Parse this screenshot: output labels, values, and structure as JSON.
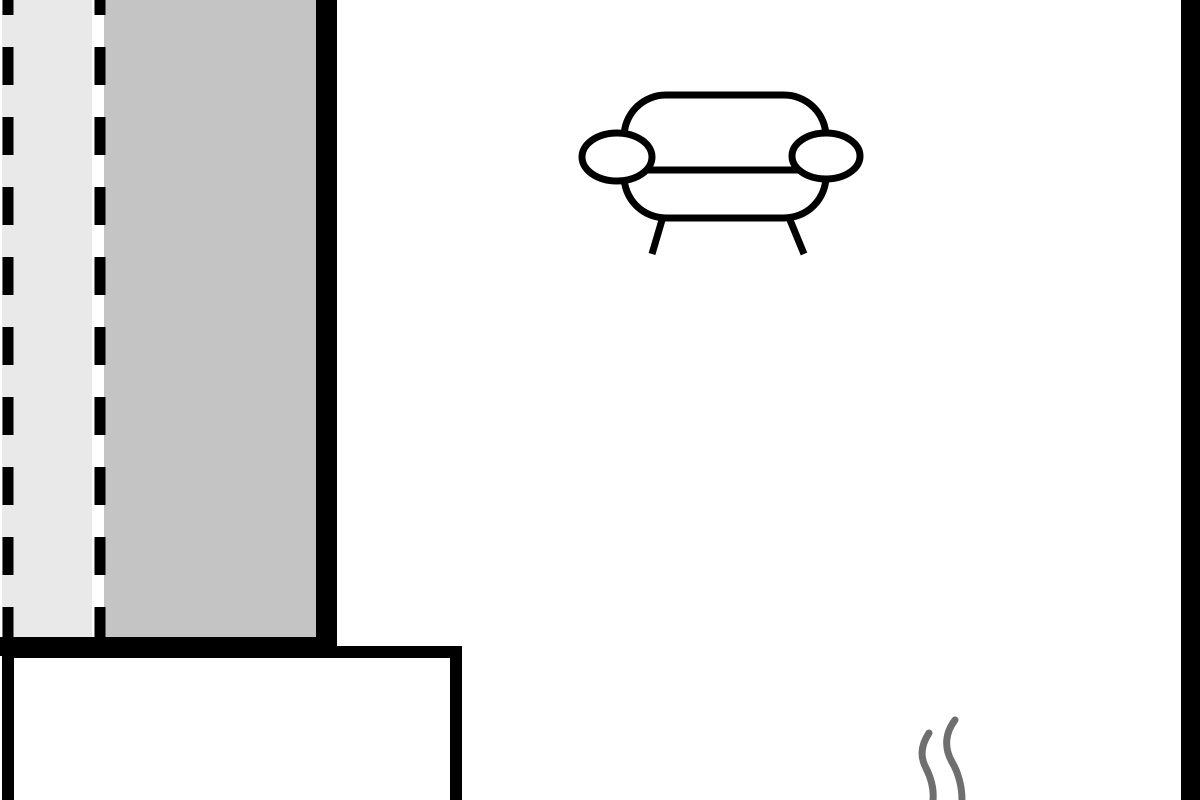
{
  "floorplan": {
    "description": "floor-plan fragment with shaded window zone, walls, sofa symbol and steam marks",
    "canvas": {
      "width": 1200,
      "height": 800,
      "background": "#ffffff"
    },
    "colors": {
      "wall": "#000000",
      "white": "#ffffff",
      "zone_light": "#e9e9e9",
      "zone_dark": "#c4c4c4",
      "steam": "#6f6f6f"
    },
    "shapes": [
      {
        "name": "shaded-zone-light",
        "type": "rect",
        "x": 2,
        "y": 0,
        "w": 90,
        "h": 638,
        "fill": "zone_light"
      },
      {
        "name": "shaded-zone-dark",
        "type": "rect",
        "x": 104,
        "y": 0,
        "w": 212,
        "h": 638,
        "fill": "zone_dark"
      },
      {
        "name": "dashed-boundary-outer",
        "type": "line",
        "x1": 8,
        "y1": 0,
        "x2": 8,
        "y2": 637,
        "stroke": "wall",
        "width": 11,
        "dash": "38 32",
        "dashoffset": 23
      },
      {
        "name": "dashed-boundary-inner",
        "type": "line",
        "x1": 100,
        "y1": 0,
        "x2": 100,
        "y2": 637,
        "stroke": "wall",
        "width": 11,
        "dash": "38 32",
        "dashoffset": 23
      },
      {
        "name": "interior-wall-left",
        "type": "rect",
        "x": 316,
        "y": 0,
        "w": 21,
        "h": 657,
        "fill": "wall"
      },
      {
        "name": "wall-ledge-bottom",
        "type": "rect",
        "x": 0,
        "y": 637,
        "w": 337,
        "h": 19,
        "fill": "wall"
      },
      {
        "name": "lower-room-block",
        "type": "rrect",
        "x": 8,
        "y": 652,
        "w": 448,
        "h": 170,
        "rx": 0,
        "stroke": "wall",
        "width": 12,
        "fill": "white"
      },
      {
        "name": "sofa-body",
        "type": "rrect",
        "x": 624,
        "y": 95,
        "w": 202,
        "h": 123,
        "rx": 42,
        "stroke": "wall",
        "width": 7,
        "fill": "white"
      },
      {
        "name": "sofa-seat-line",
        "type": "line",
        "x1": 646,
        "y1": 170,
        "x2": 798,
        "y2": 170,
        "stroke": "wall",
        "width": 7
      },
      {
        "name": "sofa-armrest-left",
        "type": "ellipse",
        "cx": 617,
        "cy": 157,
        "rx": 35,
        "ry": 24,
        "stroke": "wall",
        "width": 7,
        "fill": "white"
      },
      {
        "name": "sofa-armrest-right",
        "type": "ellipse",
        "cx": 826,
        "cy": 156,
        "rx": 34,
        "ry": 23,
        "stroke": "wall",
        "width": 7,
        "fill": "white"
      },
      {
        "name": "sofa-leg-left",
        "type": "line",
        "x1": 662,
        "y1": 220,
        "x2": 652,
        "y2": 254,
        "stroke": "wall",
        "width": 7
      },
      {
        "name": "sofa-leg-right",
        "type": "line",
        "x1": 790,
        "y1": 220,
        "x2": 804,
        "y2": 254,
        "stroke": "wall",
        "width": 7
      },
      {
        "name": "steam-squiggle-left",
        "type": "path",
        "d": "M 929 733 C 921 745 920 757 926 768 C 931 778 934 789 933 800",
        "stroke": "steam",
        "width": 7
      },
      {
        "name": "steam-squiggle-right",
        "type": "path",
        "d": "M 955 720 C 945 733 944 748 952 762 C 958 772 962 786 962 800",
        "stroke": "steam",
        "width": 7
      },
      {
        "name": "exterior-wall-right",
        "type": "rect",
        "x": 1181,
        "y": 0,
        "w": 19,
        "h": 800,
        "fill": "wall"
      }
    ]
  }
}
